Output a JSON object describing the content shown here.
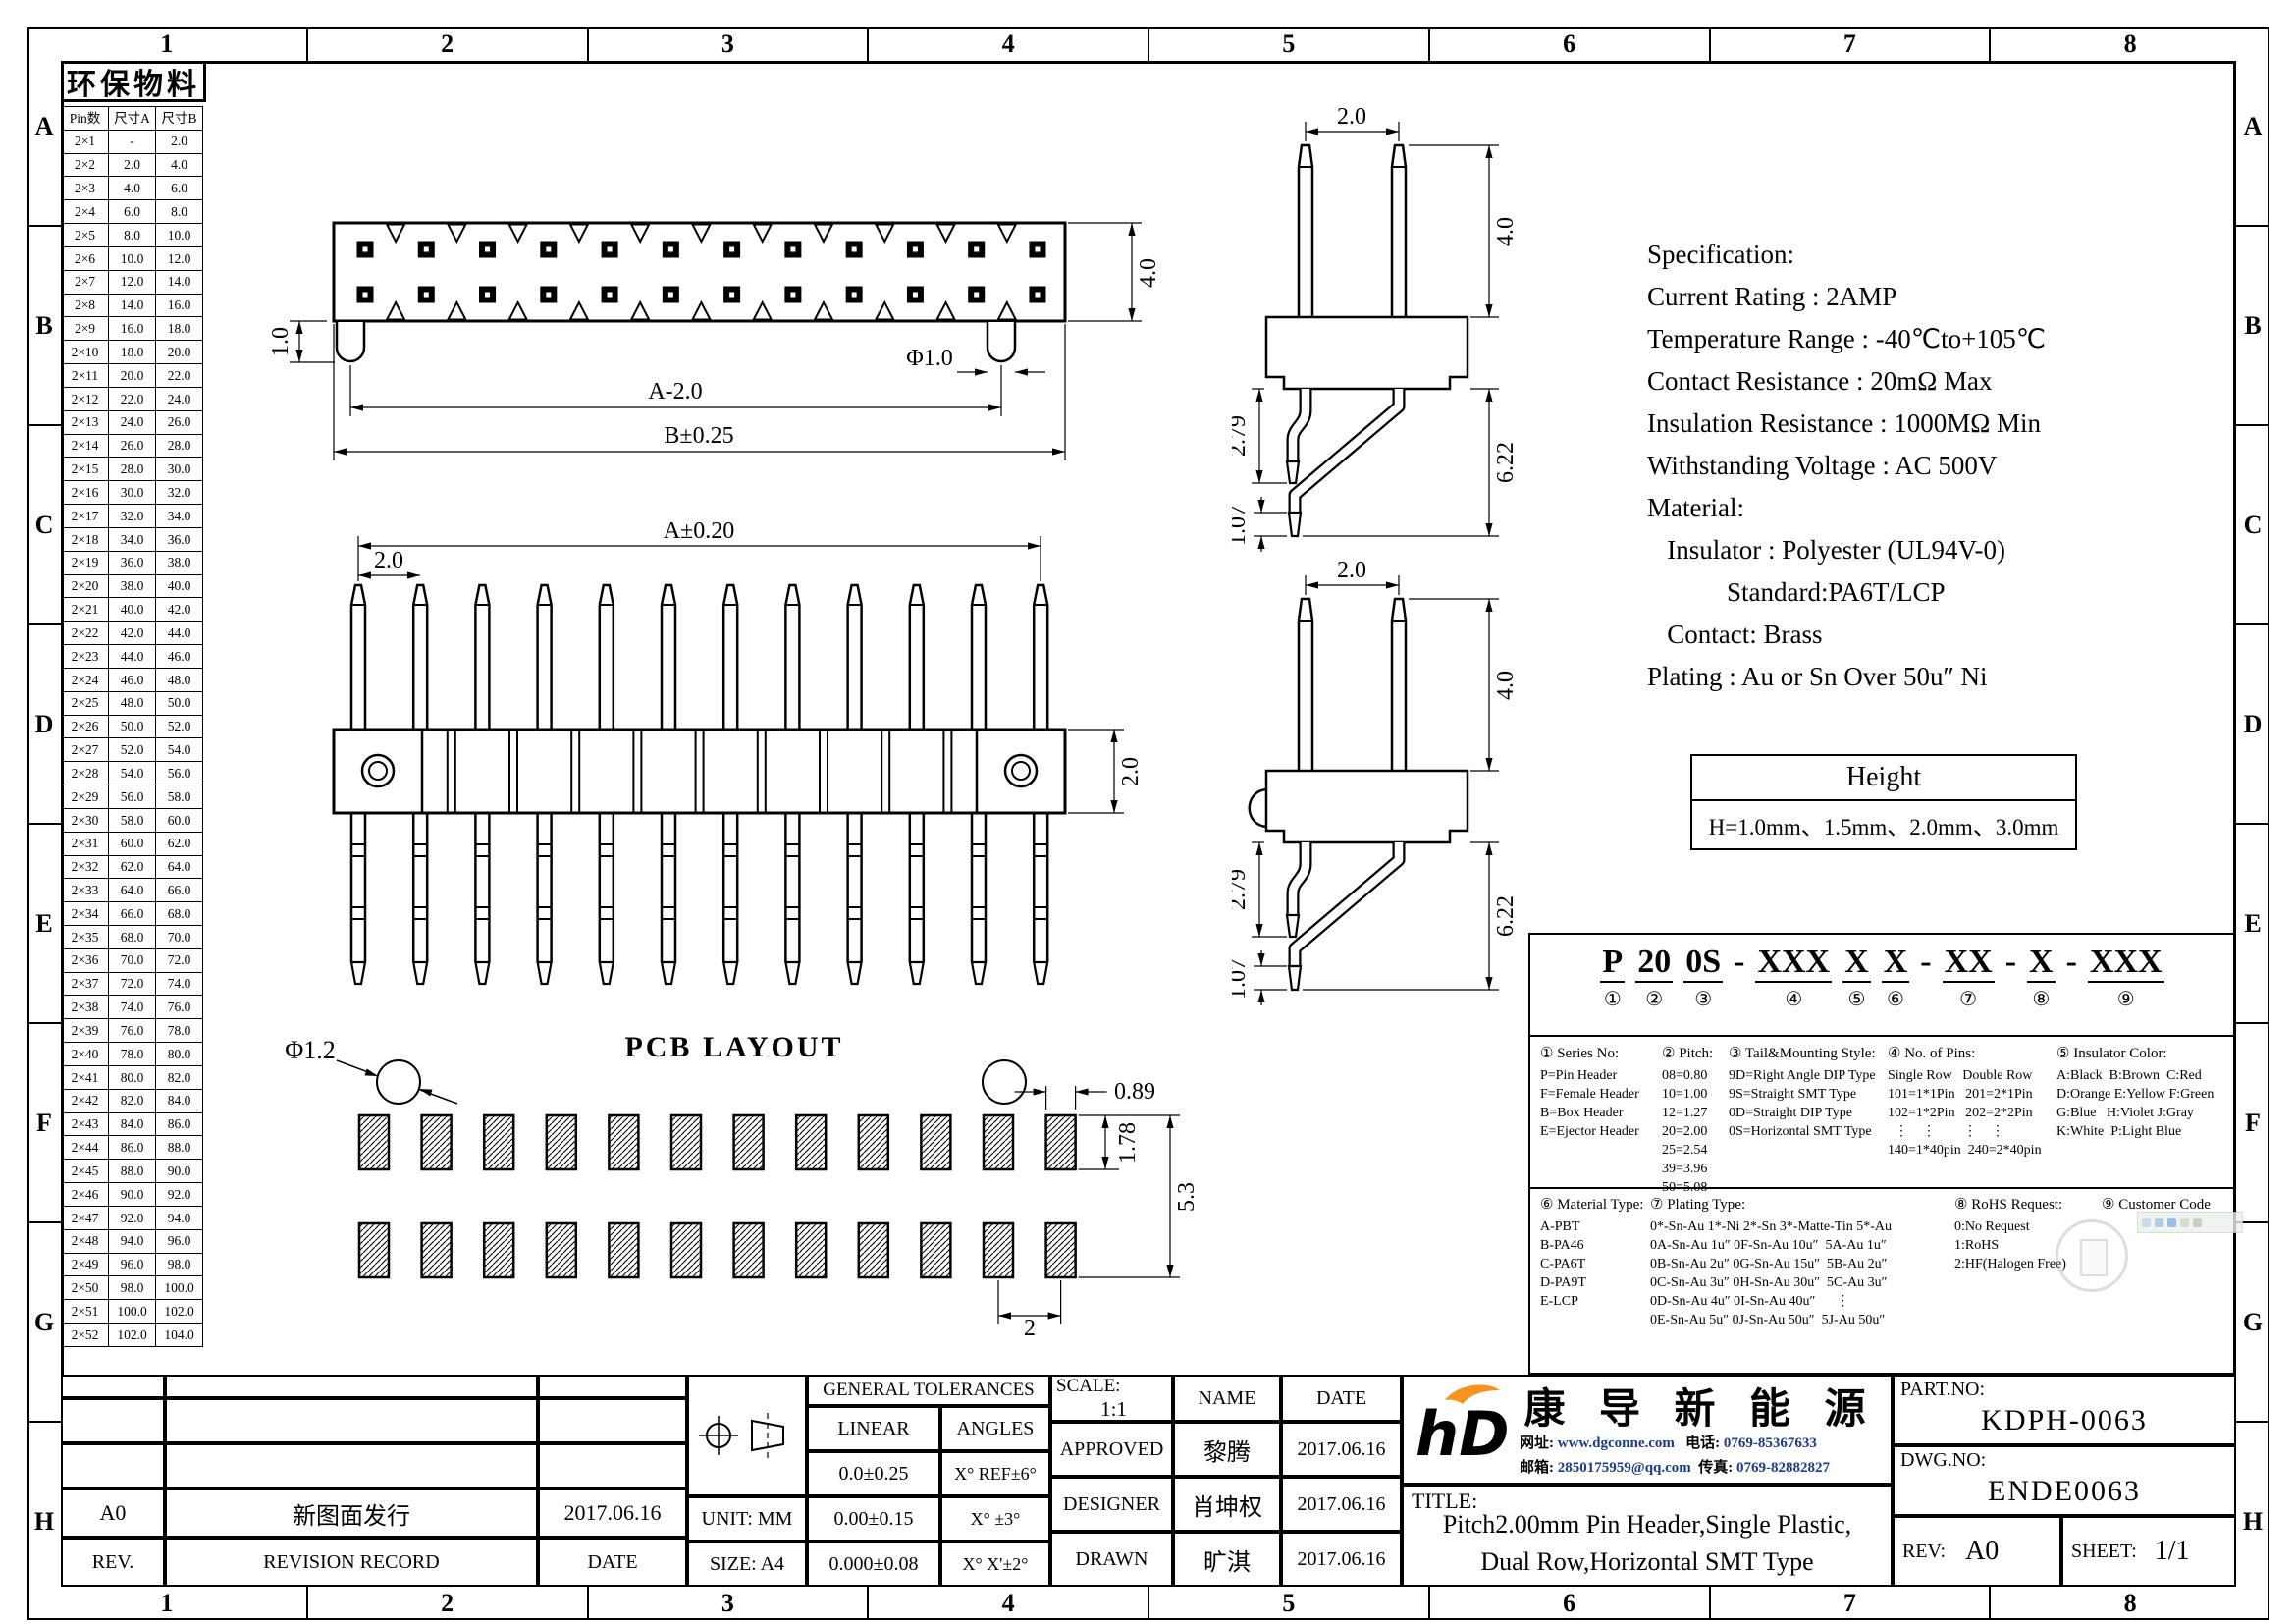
{
  "sheet": {
    "cols": [
      "1",
      "2",
      "3",
      "4",
      "5",
      "6",
      "7",
      "8"
    ],
    "rows": [
      "A",
      "B",
      "C",
      "D",
      "E",
      "F",
      "G",
      "H"
    ],
    "eco_label": "环保物料"
  },
  "pin_table": {
    "headers": [
      "Pin数",
      "尺寸A",
      "尺寸B"
    ],
    "rows": [
      [
        "2×1",
        "-",
        "2.0"
      ],
      [
        "2×2",
        "2.0",
        "4.0"
      ],
      [
        "2×3",
        "4.0",
        "6.0"
      ],
      [
        "2×4",
        "6.0",
        "8.0"
      ],
      [
        "2×5",
        "8.0",
        "10.0"
      ],
      [
        "2×6",
        "10.0",
        "12.0"
      ],
      [
        "2×7",
        "12.0",
        "14.0"
      ],
      [
        "2×8",
        "14.0",
        "16.0"
      ],
      [
        "2×9",
        "16.0",
        "18.0"
      ],
      [
        "2×10",
        "18.0",
        "20.0"
      ],
      [
        "2×11",
        "20.0",
        "22.0"
      ],
      [
        "2×12",
        "22.0",
        "24.0"
      ],
      [
        "2×13",
        "24.0",
        "26.0"
      ],
      [
        "2×14",
        "26.0",
        "28.0"
      ],
      [
        "2×15",
        "28.0",
        "30.0"
      ],
      [
        "2×16",
        "30.0",
        "32.0"
      ],
      [
        "2×17",
        "32.0",
        "34.0"
      ],
      [
        "2×18",
        "34.0",
        "36.0"
      ],
      [
        "2×19",
        "36.0",
        "38.0"
      ],
      [
        "2×20",
        "38.0",
        "40.0"
      ],
      [
        "2×21",
        "40.0",
        "42.0"
      ],
      [
        "2×22",
        "42.0",
        "44.0"
      ],
      [
        "2×23",
        "44.0",
        "46.0"
      ],
      [
        "2×24",
        "46.0",
        "48.0"
      ],
      [
        "2×25",
        "48.0",
        "50.0"
      ],
      [
        "2×26",
        "50.0",
        "52.0"
      ],
      [
        "2×27",
        "52.0",
        "54.0"
      ],
      [
        "2×28",
        "54.0",
        "56.0"
      ],
      [
        "2×29",
        "56.0",
        "58.0"
      ],
      [
        "2×30",
        "58.0",
        "60.0"
      ],
      [
        "2×31",
        "60.0",
        "62.0"
      ],
      [
        "2×32",
        "62.0",
        "64.0"
      ],
      [
        "2×33",
        "64.0",
        "66.0"
      ],
      [
        "2×34",
        "66.0",
        "68.0"
      ],
      [
        "2×35",
        "68.0",
        "70.0"
      ],
      [
        "2×36",
        "70.0",
        "72.0"
      ],
      [
        "2×37",
        "72.0",
        "74.0"
      ],
      [
        "2×38",
        "74.0",
        "76.0"
      ],
      [
        "2×39",
        "76.0",
        "78.0"
      ],
      [
        "2×40",
        "78.0",
        "80.0"
      ],
      [
        "2×41",
        "80.0",
        "82.0"
      ],
      [
        "2×42",
        "82.0",
        "84.0"
      ],
      [
        "2×43",
        "84.0",
        "86.0"
      ],
      [
        "2×44",
        "86.0",
        "88.0"
      ],
      [
        "2×45",
        "88.0",
        "90.0"
      ],
      [
        "2×46",
        "90.0",
        "92.0"
      ],
      [
        "2×47",
        "92.0",
        "94.0"
      ],
      [
        "2×48",
        "94.0",
        "96.0"
      ],
      [
        "2×49",
        "96.0",
        "98.0"
      ],
      [
        "2×50",
        "98.0",
        "100.0"
      ],
      [
        "2×51",
        "100.0",
        "102.0"
      ],
      [
        "2×52",
        "102.0",
        "104.0"
      ]
    ]
  },
  "spec": {
    "lines": [
      "Specification:",
      "Current Rating : 2AMP",
      "Temperature Range : -40℃to+105℃",
      "Contact Resistance : 20mΩ Max",
      "Insulation Resistance : 1000MΩ Min",
      "Withstanding Voltage : AC 500V",
      "Material:",
      "   Insulator : Polyester (UL94V-0)",
      "            Standard:PA6T/LCP",
      "   Contact: Brass",
      "Plating : Au or Sn Over 50u″ Ni"
    ]
  },
  "height_table": {
    "title": "Height",
    "value": "H=1.0mm、1.5mm、2.0mm、3.0mm"
  },
  "dims": {
    "top_view": {
      "left": "1.0",
      "a": "A-2.0",
      "b": "B±0.25",
      "phi": "Φ1.0",
      "height": "4.0"
    },
    "side_view": {
      "pitch": "2.0",
      "pin": "4.0",
      "short_leg": "2.79",
      "long_leg": "6.22",
      "tip": "1.07"
    },
    "front_view": {
      "a": "A±0.20",
      "pitch": "2.0",
      "body": "2.0"
    },
    "pcb": {
      "phi": "Φ1.2",
      "title": "PCB LAYOUT",
      "pad_w": "0.89",
      "pad_h": "1.78",
      "span": "5.3",
      "pitch": "2"
    }
  },
  "drawing_meta": {
    "pins_per_row": 12,
    "pin_rows": 2,
    "pcb_pads_per_row": 12
  },
  "ordering": {
    "code_segments": [
      {
        "t": "P",
        "n": "①"
      },
      {
        "t": "20",
        "n": "②"
      },
      {
        "t": "0S",
        "n": "③"
      },
      {
        "t": "-"
      },
      {
        "t": "XXX",
        "n": "④"
      },
      {
        "t": "X",
        "n": "⑤"
      },
      {
        "t": "X",
        "n": "⑥"
      },
      {
        "t": "-"
      },
      {
        "t": "XX",
        "n": "⑦"
      },
      {
        "t": "-"
      },
      {
        "t": "X",
        "n": "⑧"
      },
      {
        "t": "-"
      },
      {
        "t": "XXX",
        "n": "⑨"
      }
    ],
    "sections_top": [
      {
        "title": "① Series No:",
        "lines": [
          "P=Pin Header",
          "F=Female Header",
          "B=Box Header",
          "E=Ejector Header"
        ]
      },
      {
        "title": "② Pitch:",
        "lines": [
          "08=0.80",
          "10=1.00",
          "12=1.27",
          "20=2.00",
          "25=2.54",
          "39=3.96",
          "50=5.08"
        ]
      },
      {
        "title": "③ Tail&Mounting Style:",
        "lines": [
          "9D=Right Angle DIP Type",
          "9S=Straight SMT Type",
          "0D=Straight DIP Type",
          "0S=Horizontal SMT Type"
        ]
      },
      {
        "title": "④ No. of Pins:",
        "lines": [
          "Single Row   Double Row",
          "101=1*1Pin   201=2*1Pin",
          "102=1*2Pin   202=2*2Pin",
          "  ⋮    ⋮        ⋮    ⋮",
          "140=1*40pin  240=2*40pin"
        ]
      },
      {
        "title": "⑤ Insulator Color:",
        "lines": [
          "A:Black  B:Brown  C:Red",
          "D:Orange E:Yellow F:Green",
          "G:Blue   H:Violet J:Gray",
          "K:White  P:Light Blue"
        ]
      }
    ],
    "sections_bottom": [
      {
        "title": "⑥ Material Type:",
        "lines": [
          "A-PBT",
          "B-PA46",
          "C-PA6T",
          "D-PA9T",
          "E-LCP"
        ]
      },
      {
        "title": "⑦ Plating Type:",
        "lines": [
          "0*-Sn-Au 1*-Ni 2*-Sn 3*-Matte-Tin 5*-Au",
          "0A-Sn-Au 1u″ 0F-Sn-Au 10u″  5A-Au 1u″",
          "0B-Sn-Au 2u″ 0G-Sn-Au 15u″  5B-Au 2u″",
          "0C-Sn-Au 3u″ 0H-Sn-Au 30u″  5C-Au 3u″",
          "0D-Sn-Au 4u″ 0I-Sn-Au 40u″      ⋮",
          "0E-Sn-Au 5u″ 0J-Sn-Au 50u″  5J-Au 50u″"
        ]
      },
      {
        "title": "⑧ RoHS Request:",
        "lines": [
          "0:No Request",
          "1:RoHS",
          "2:HF(Halogen Free)"
        ]
      },
      {
        "title": "⑨ Customer Code",
        "lines": []
      }
    ]
  },
  "title_block": {
    "general_tolerances": "GENERAL TOLERANCES",
    "linear": "LINEAR",
    "angles": "ANGLES",
    "tol_rows": [
      [
        "0.0±0.25",
        "X° REF±6°"
      ],
      [
        "0.00±0.15",
        "X° ±3°"
      ],
      [
        "0.000±0.08",
        "X° X'±2°"
      ]
    ],
    "unit": "UNIT: MM",
    "size": "SIZE: A4",
    "rev_row": {
      "rev": "A0",
      "record": "新图面发行",
      "date": "2017.06.16"
    },
    "rev_header": {
      "rev": "REV.",
      "record": "REVISION RECORD",
      "date": "DATE"
    },
    "scale_label": "SCALE:",
    "scale_value": "1:1",
    "name_label": "NAME",
    "date_label": "DATE",
    "approvals": [
      {
        "role": "APPROVED",
        "name": "黎腾",
        "date": "2017.06.16"
      },
      {
        "role": "DESIGNER",
        "name": "肖坤权",
        "date": "2017.06.16"
      },
      {
        "role": "DRAWN",
        "name": "旷淇",
        "date": "2017.06.16"
      }
    ],
    "company": {
      "name": "康 导 新 能 源",
      "contact1_label": "网址:",
      "contact1": "www.dgconne.com",
      "contact2_label": "电话:",
      "contact2": "0769-85367633",
      "contact3_label": "邮箱:",
      "contact3": "2850175959@qq.com",
      "contact4_label": "传真:",
      "contact4": "0769-82882827"
    },
    "title_label": "TITLE:",
    "title_line1": "Pitch2.00mm Pin Header,Single Plastic,",
    "title_line2": "Dual Row,Horizontal SMT Type",
    "part_no_label": "PART.NO:",
    "part_no": "KDPH-0063",
    "dwg_no_label": "DWG.NO:",
    "dwg_no": "ENDE0063",
    "rev_label": "REV:",
    "rev": "A0",
    "sheet_label": "SHEET:",
    "sheet": "1/1"
  },
  "colors": {
    "line": "#000000",
    "logo_blue": "#29abe2",
    "logo_orange": "#f7931e",
    "contact_text": "#1a3a8c"
  }
}
